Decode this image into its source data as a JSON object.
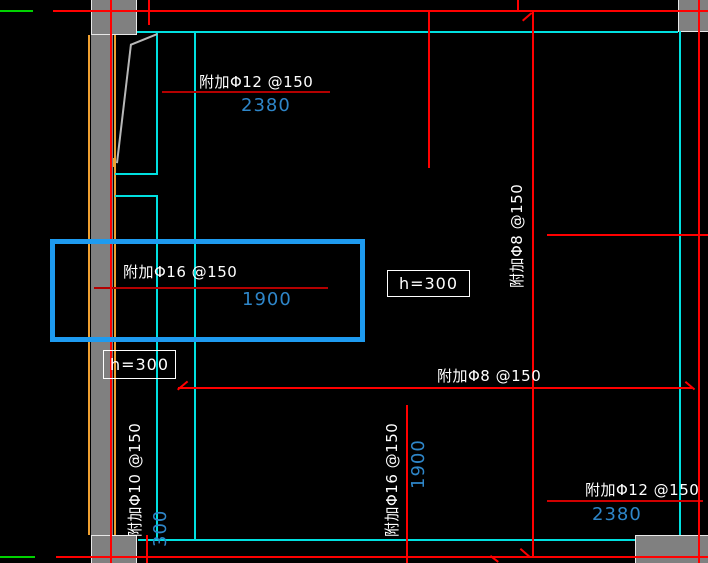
{
  "annotations": {
    "top_rebar": {
      "label": "附加Φ12 @150",
      "dim": "2380"
    },
    "selected_rebar": {
      "label": "附加Φ16 @150",
      "dim": "1900"
    },
    "right_rebar_vertical": {
      "label": "附加Φ8 @150"
    },
    "slab_thickness_center": {
      "label": "h=300"
    },
    "slab_thickness_left": {
      "label": "h=300"
    },
    "bottom_rebar_horizontal": {
      "label": "附加Φ8 @150"
    },
    "left_rebar_vertical": {
      "label": "附加Φ10 @150",
      "dim": "300"
    },
    "center_rebar_vertical": {
      "label": "附加Φ16 @150",
      "dim": "1900"
    },
    "bottom_right_rebar": {
      "label": "附加Φ12 @150",
      "dim": "2380"
    }
  },
  "colors": {
    "background": "#000000",
    "grid_red": "#ff0000",
    "label_underline_red": "#b40000",
    "slab_edge_cyan": "#00e0e0",
    "wall_edge_orange": "#f0a030",
    "column_gray": "#808080",
    "dimension_blue": "#2e86c9",
    "selection_highlight_blue": "#1e9bf0",
    "annotation_white": "#ffffff",
    "axis_green": "#00d200"
  }
}
